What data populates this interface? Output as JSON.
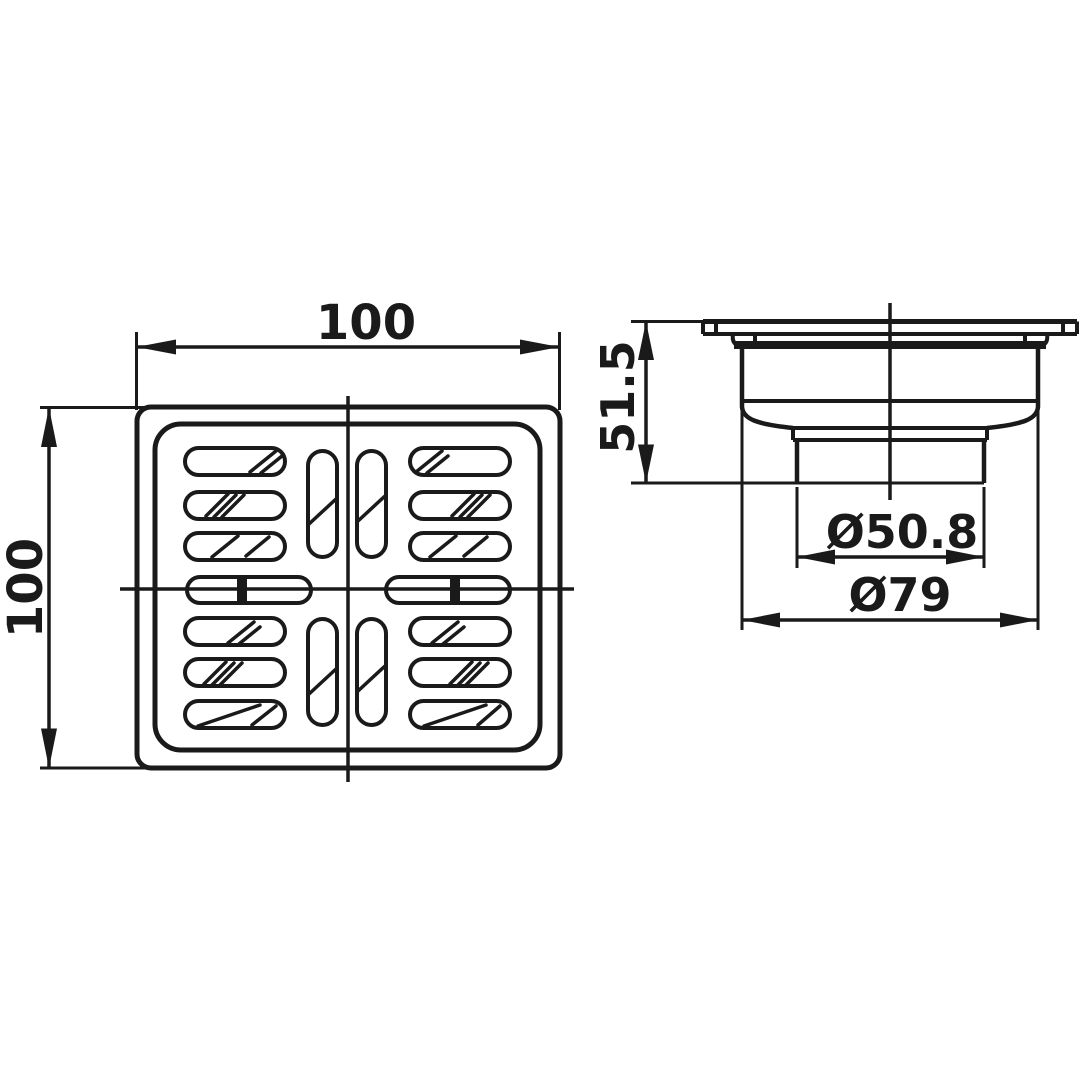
{
  "canvas": {
    "width": 1090,
    "height": 1090,
    "background": "#ffffff",
    "line_color": "#1a1a1a"
  },
  "drawing": {
    "type": "technical-drawing",
    "subject": "square floor drain with slotted strainer grate and outlet body",
    "views": [
      {
        "id": "top-view",
        "name": "grate top view",
        "dimensions": [
          {
            "label": "100",
            "axis": "horizontal",
            "position": "top"
          },
          {
            "label": "100",
            "axis": "vertical",
            "position": "left"
          }
        ]
      },
      {
        "id": "side-view",
        "name": "drain body side view",
        "dimensions": [
          {
            "label": "51.5",
            "axis": "vertical",
            "position": "left"
          },
          {
            "label": "Ø50.8",
            "axis": "horizontal",
            "position": "outlet-pipe"
          },
          {
            "label": "Ø79",
            "axis": "horizontal",
            "position": "body"
          }
        ]
      }
    ]
  }
}
